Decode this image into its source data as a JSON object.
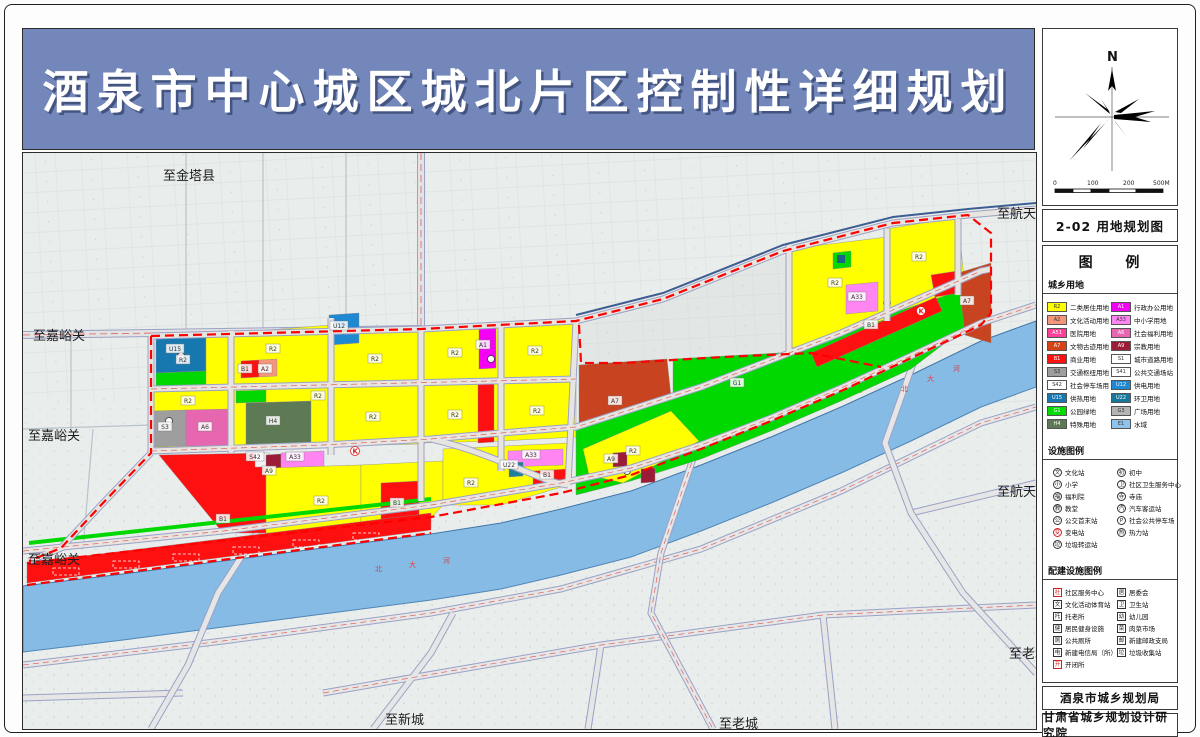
{
  "banner": {
    "title": "酒泉市中心城区城北片区控制性详细规划"
  },
  "panel": {
    "compass": {
      "north_label": "N"
    },
    "scalebar": {
      "labels": [
        "0",
        "100",
        "200",
        "500M"
      ]
    },
    "map_title": "2-02 用地规划图",
    "legend": {
      "title": "图 例",
      "landuse_header": "城乡用地",
      "landuse_left": [
        {
          "code": "R2",
          "color": "#ffff00",
          "label": "二类居住用地"
        },
        {
          "code": "A2",
          "color": "#f59579",
          "label": "文化活动用地"
        },
        {
          "code": "A51",
          "color": "#ff4098",
          "label": "医院用地"
        },
        {
          "code": "A7",
          "color": "#d84315",
          "label": "文物古迹用地"
        },
        {
          "code": "B1",
          "color": "#fe1010",
          "label": "商业用地"
        },
        {
          "code": "S3",
          "color": "#9e9e9e",
          "label": "交通枢纽用地"
        },
        {
          "code": "S42",
          "color": "#ffffff",
          "label": "社会停车场用地"
        },
        {
          "code": "U15",
          "color": "#1778b0",
          "label": "供热用地"
        },
        {
          "code": "G1",
          "color": "#00dc00",
          "label": "公园绿地"
        },
        {
          "code": "H4",
          "color": "#5d7a54",
          "label": "特殊用地"
        }
      ],
      "landuse_right": [
        {
          "code": "A1",
          "color": "#f400f4",
          "label": "行政办公用地"
        },
        {
          "code": "A33",
          "color": "#ff85f3",
          "label": "中小学用地"
        },
        {
          "code": "A6",
          "color": "#e667b0",
          "label": "社会福利用地"
        },
        {
          "code": "A9",
          "color": "#9c1c38",
          "label": "宗教用地"
        },
        {
          "code": "S1",
          "color": "#ffffff",
          "label": "城市道路用地"
        },
        {
          "code": "S41",
          "color": "#ffffff",
          "label": "公共交通场站用地"
        },
        {
          "code": "U12",
          "color": "#1e88d0",
          "label": "供电用地"
        },
        {
          "code": "U22",
          "color": "#17789c",
          "label": "环卫用地"
        },
        {
          "code": "G3",
          "color": "#b4b4b4",
          "label": "广场用地"
        },
        {
          "code": "E1",
          "color": "#8fc3ec",
          "label": "水域"
        }
      ],
      "facility_header": "设施图例",
      "facility_left": [
        {
          "glyph": "文",
          "label": "文化站"
        },
        {
          "glyph": "小",
          "label": "小学"
        },
        {
          "glyph": "福",
          "label": "福利院"
        },
        {
          "glyph": "教",
          "label": "教堂"
        },
        {
          "glyph": "公",
          "label": "公交首末站"
        },
        {
          "glyph": "变",
          "label": "变电站",
          "color": "#d02020"
        },
        {
          "glyph": "垃",
          "label": "垃圾转运站"
        }
      ],
      "facility_right": [
        {
          "glyph": "初",
          "label": "初中"
        },
        {
          "glyph": "卫",
          "label": "社区卫生服务中心"
        },
        {
          "glyph": "寺",
          "label": "寺庙"
        },
        {
          "glyph": "汽",
          "label": "汽车客运站"
        },
        {
          "glyph": "P",
          "label": "社会公共停车场"
        },
        {
          "glyph": "热",
          "label": "热力站"
        }
      ],
      "supporting_header": "配建设施图例",
      "supporting_left": [
        {
          "glyph": "社",
          "label": "社区服务中心",
          "color": "#d02020"
        },
        {
          "glyph": "文",
          "label": "文化活动体育站"
        },
        {
          "glyph": "托",
          "label": "托老所"
        },
        {
          "glyph": "健",
          "label": "居民健身设施"
        },
        {
          "glyph": "厕",
          "label": "公共厕所"
        },
        {
          "glyph": "电",
          "label": "新建电信局（所）"
        },
        {
          "glyph": "开",
          "label": "开闭所",
          "color": "#d02020"
        }
      ],
      "supporting_right": [
        {
          "glyph": "居",
          "label": "居委会"
        },
        {
          "glyph": "卫",
          "label": "卫生站"
        },
        {
          "glyph": "幼",
          "label": "幼儿园"
        },
        {
          "glyph": "菜",
          "label": "肉菜市场"
        },
        {
          "glyph": "邮",
          "label": "新建邮政支局"
        },
        {
          "glyph": "垃",
          "label": "垃圾收集站"
        }
      ]
    },
    "footer1": "酒泉市城乡规划局",
    "footer2": "甘肃省城乡规划设计研究院"
  },
  "map": {
    "edge_labels": [
      {
        "text": "至金塔县",
        "x": 140,
        "y": 16
      },
      {
        "text": "至航天城",
        "x": 974,
        "y": 54
      },
      {
        "text": "至嘉峪关",
        "x": 10,
        "y": 176
      },
      {
        "text": "至嘉峪关",
        "x": 5,
        "y": 276
      },
      {
        "text": "至航天城",
        "x": 974,
        "y": 332
      },
      {
        "text": "至嘉峪关",
        "x": 5,
        "y": 400
      },
      {
        "text": "至老城",
        "x": 986,
        "y": 494
      },
      {
        "text": "至新城",
        "x": 362,
        "y": 560
      },
      {
        "text": "至老城",
        "x": 696,
        "y": 564
      }
    ],
    "parcel_codes": [
      {
        "code": "R2",
        "x": 160,
        "y": 207
      },
      {
        "code": "R2",
        "x": 250,
        "y": 196
      },
      {
        "code": "R2",
        "x": 352,
        "y": 206
      },
      {
        "code": "R2",
        "x": 432,
        "y": 200
      },
      {
        "code": "R2",
        "x": 512,
        "y": 198
      },
      {
        "code": "R2",
        "x": 165,
        "y": 248
      },
      {
        "code": "R2",
        "x": 350,
        "y": 264
      },
      {
        "code": "R2",
        "x": 432,
        "y": 262
      },
      {
        "code": "R2",
        "x": 514,
        "y": 258
      },
      {
        "code": "R2",
        "x": 295,
        "y": 243
      },
      {
        "code": "R2",
        "x": 298,
        "y": 348
      },
      {
        "code": "R2",
        "x": 448,
        "y": 330
      },
      {
        "code": "R2",
        "x": 610,
        "y": 298
      },
      {
        "code": "R2",
        "x": 812,
        "y": 130
      },
      {
        "code": "R2",
        "x": 896,
        "y": 104
      },
      {
        "code": "U15",
        "x": 152,
        "y": 196
      },
      {
        "code": "B1",
        "x": 222,
        "y": 216
      },
      {
        "code": "A2",
        "x": 242,
        "y": 216
      },
      {
        "code": "U12",
        "x": 316,
        "y": 173
      },
      {
        "code": "A1",
        "x": 460,
        "y": 192
      },
      {
        "code": "S3",
        "x": 142,
        "y": 274
      },
      {
        "code": "A6",
        "x": 182,
        "y": 274
      },
      {
        "code": "H4",
        "x": 250,
        "y": 268
      },
      {
        "code": "A33",
        "x": 272,
        "y": 304
      },
      {
        "code": "A33",
        "x": 508,
        "y": 302
      },
      {
        "code": "A33",
        "x": 834,
        "y": 144
      },
      {
        "code": "A9",
        "x": 246,
        "y": 318
      },
      {
        "code": "A9",
        "x": 588,
        "y": 306
      },
      {
        "code": "S42",
        "x": 232,
        "y": 304
      },
      {
        "code": "B1",
        "x": 374,
        "y": 350
      },
      {
        "code": "B1",
        "x": 524,
        "y": 322
      },
      {
        "code": "B1",
        "x": 200,
        "y": 366
      },
      {
        "code": "B1",
        "x": 848,
        "y": 172
      },
      {
        "code": "A7",
        "x": 592,
        "y": 248
      },
      {
        "code": "A7",
        "x": 944,
        "y": 148
      },
      {
        "code": "G1",
        "x": 714,
        "y": 230
      },
      {
        "code": "U22",
        "x": 486,
        "y": 312
      },
      {
        "code": "K",
        "x": 332,
        "y": 298
      },
      {
        "code": "K",
        "x": 898,
        "y": 158
      }
    ],
    "river_labels": [
      {
        "text": "北",
        "x": 352,
        "y": 418
      },
      {
        "text": "大",
        "x": 386,
        "y": 414
      },
      {
        "text": "河",
        "x": 420,
        "y": 410
      },
      {
        "text": "北",
        "x": 878,
        "y": 238
      },
      {
        "text": "大",
        "x": 904,
        "y": 228
      },
      {
        "text": "河",
        "x": 930,
        "y": 218
      }
    ]
  }
}
